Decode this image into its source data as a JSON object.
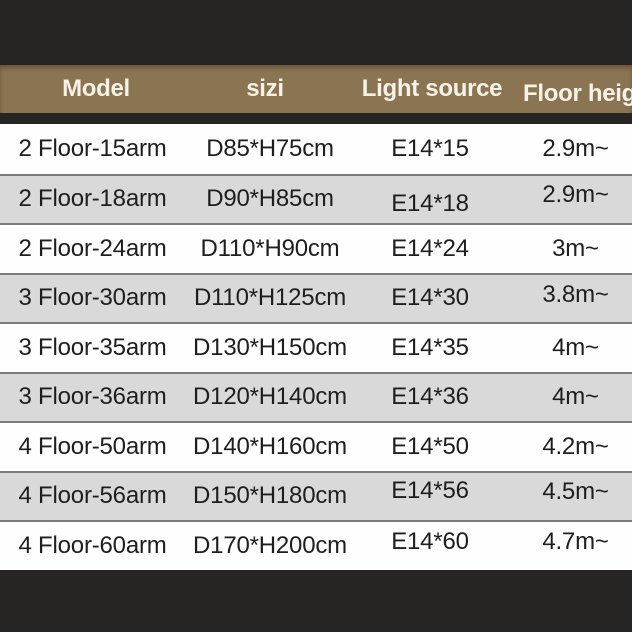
{
  "page": {
    "background_color": "#262524"
  },
  "header": {
    "background_color": "#8b7452",
    "text_color": "#f7f2e7"
  },
  "table_style": {
    "row_odd_color": "#fefefe",
    "row_even_color": "#d9d9d9",
    "separator_color": "#7b7b7b",
    "text_color": "#1e1e1e"
  },
  "chart_data": {
    "type": "table",
    "title": "",
    "columns": [
      "Model",
      "sizi",
      "Light source",
      "Floor height"
    ],
    "rows": [
      [
        "2 Floor-15arm",
        "D85*H75cm",
        "E14*15",
        "2.9m~"
      ],
      [
        "2 Floor-18arm",
        "D90*H85cm",
        "E14*18",
        "2.9m~"
      ],
      [
        "2 Floor-24arm",
        "D110*H90cm",
        "E14*24",
        "3m~"
      ],
      [
        "3 Floor-30arm",
        "D110*H125cm",
        "E14*30",
        "3.8m~"
      ],
      [
        "3 Floor-35arm",
        "D130*H150cm",
        "E14*35",
        "4m~"
      ],
      [
        "3 Floor-36arm",
        "D120*H140cm",
        "E14*36",
        "4m~"
      ],
      [
        "4 Floor-50arm",
        "D140*H160cm",
        "E14*50",
        "4.2m~"
      ],
      [
        "4 Floor-56arm",
        "D150*H180cm",
        "E14*56",
        "4.5m~"
      ],
      [
        "4 Floor-60arm",
        "D170*H200cm",
        "E14*60",
        "4.7m~"
      ]
    ],
    "layout": {
      "header_band": "tan banner above table, last column header clipped at right edge",
      "stripes": "alternating white and light gray rows",
      "grid": "horizontal separators only"
    }
  }
}
